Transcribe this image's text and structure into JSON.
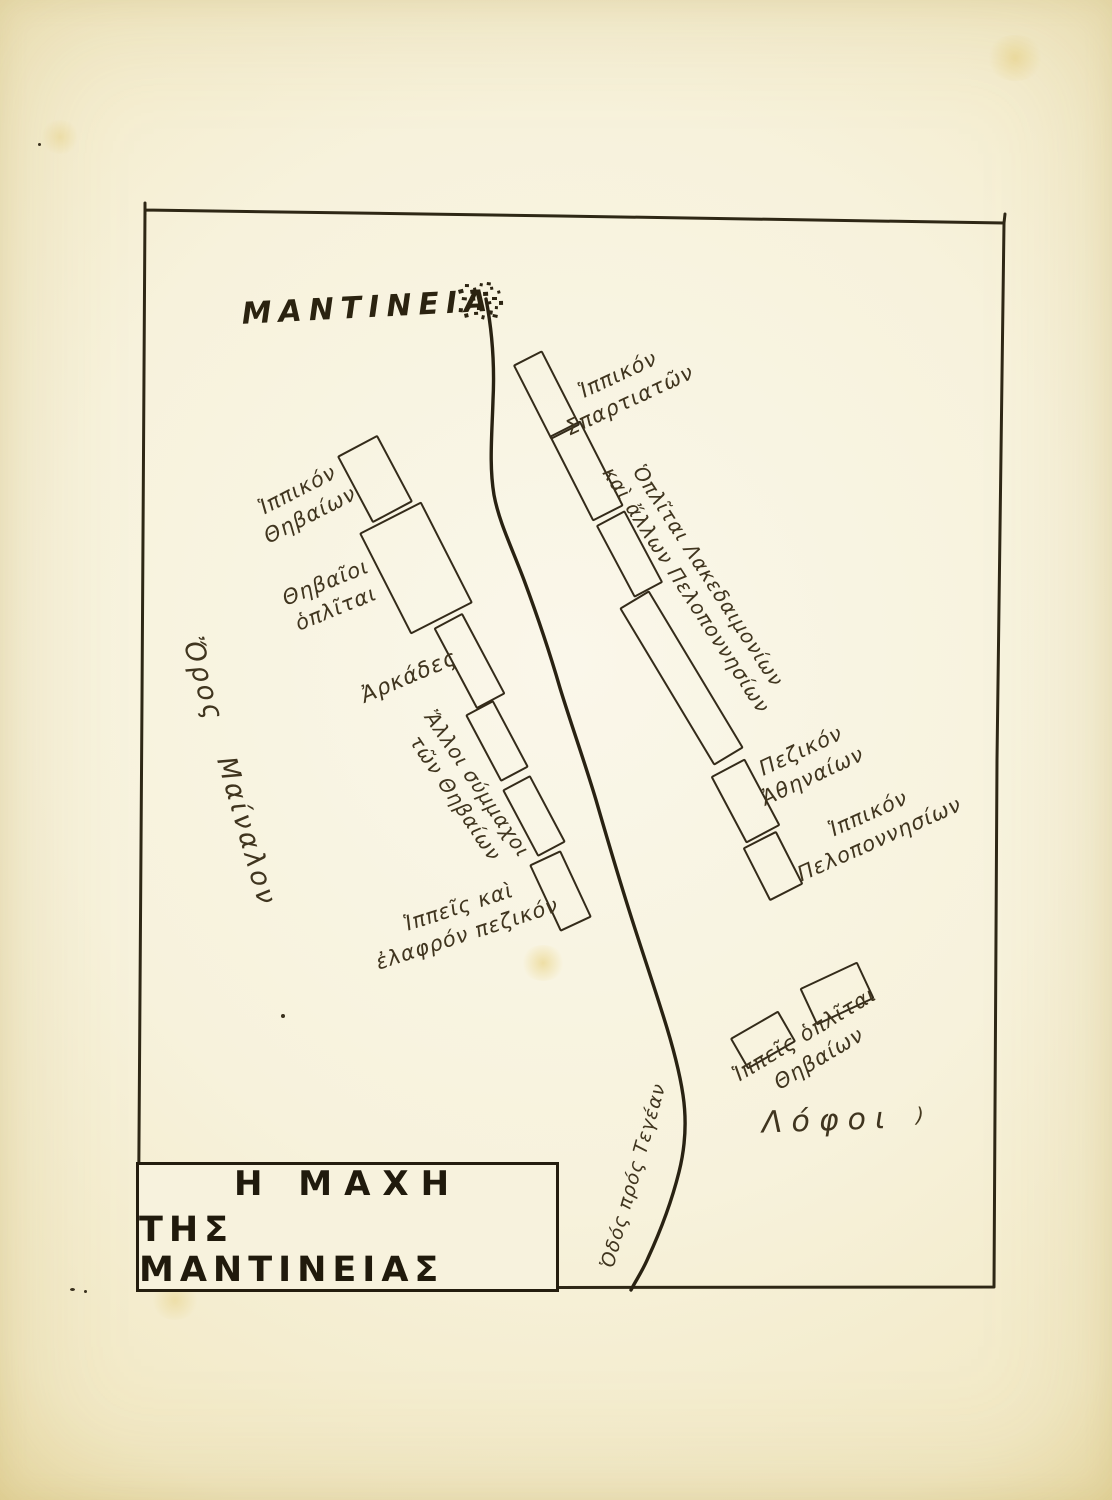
{
  "page": {
    "kind": "hand-drawn battle map, scanned book plate",
    "language": "Greek (polytonic)"
  },
  "title_box": {
    "line1": "Η ΜΑΧΗ",
    "line2": "ΤΗΣ ΜΑΝΤΙΝΕΙΑΣ"
  },
  "map": {
    "ink_color": "#342b1a",
    "paper_color": "#f7f2dc",
    "city": {
      "name": "MANTINEIA",
      "symbol": "town-cluster"
    },
    "terrain": {
      "mountain": "Ὄρος  Μαίναλον",
      "hills": "Λόφοι",
      "road": "Ὁδός πρός Τεγέαν"
    },
    "units": [
      {
        "name": "theban-cavalry-box",
        "x": 373,
        "y": 477,
        "w": 42,
        "h": 72,
        "rot": -28
      },
      {
        "name": "theban-hoplites-box",
        "x": 414,
        "y": 566,
        "w": 66,
        "h": 110,
        "rot": -27
      },
      {
        "name": "arcadians-box",
        "x": 467,
        "y": 659,
        "w": 29,
        "h": 88,
        "rot": -28
      },
      {
        "name": "theban-allies-box-1",
        "x": 495,
        "y": 739,
        "w": 28,
        "h": 72,
        "rot": -28
      },
      {
        "name": "theban-allies-box-2",
        "x": 532,
        "y": 814,
        "w": 28,
        "h": 72,
        "rot": -28
      },
      {
        "name": "light-infantry-box",
        "x": 558,
        "y": 889,
        "w": 31,
        "h": 70,
        "rot": -25
      },
      {
        "name": "spartan-cavalry-box",
        "x": 544,
        "y": 393,
        "w": 29,
        "h": 80,
        "rot": -27
      },
      {
        "name": "lacedaemonian-box-1",
        "x": 584,
        "y": 469,
        "w": 31,
        "h": 92,
        "rot": -27
      },
      {
        "name": "lacedaemonian-box-2",
        "x": 627,
        "y": 552,
        "w": 29,
        "h": 78,
        "rot": -28
      },
      {
        "name": "lacedaemonian-box-long",
        "x": 679,
        "y": 676,
        "w": 31,
        "h": 180,
        "rot": -31
      },
      {
        "name": "athenian-infantry-box",
        "x": 743,
        "y": 799,
        "w": 35,
        "h": 72,
        "rot": -28
      },
      {
        "name": "peloponnesian-cavalry-box",
        "x": 771,
        "y": 864,
        "w": 34,
        "h": 56,
        "rot": -27
      },
      {
        "name": "theban-detachment-box-1",
        "x": 761,
        "y": 1038,
        "w": 52,
        "h": 32,
        "rot": -30
      },
      {
        "name": "theban-detachment-box-2",
        "x": 835,
        "y": 991,
        "w": 60,
        "h": 37,
        "rot": -25
      }
    ],
    "labels": [
      {
        "name": "mantineia-city-label",
        "lines": [
          "MANTINEIA"
        ],
        "x": 368,
        "y": 308,
        "rot": -3,
        "size": 30,
        "ls": 7,
        "cls": "city-label"
      },
      {
        "name": "spartan-cavalry-label",
        "lines": [
          "Ἱππικόν",
          "Σπαρτιατῶν"
        ],
        "x": 624,
        "y": 388,
        "rot": -25,
        "size": 21
      },
      {
        "name": "lacedaemonian-hoplites-label",
        "lines": [
          "Ὁπλῖται Λακεδαιμονίων",
          "καὶ ἄλλων Πελοποννησίων"
        ],
        "x": 697,
        "y": 583,
        "rot": 57,
        "size": 20
      },
      {
        "name": "athenian-infantry-label",
        "lines": [
          "Πεζικόν",
          "Ἀθηναίων"
        ],
        "x": 807,
        "y": 764,
        "rot": -25,
        "size": 21
      },
      {
        "name": "peloponnesian-cavalry-label",
        "lines": [
          "Ἱππικόν",
          "Πελοποννησίων"
        ],
        "x": 874,
        "y": 827,
        "rot": -24,
        "size": 21
      },
      {
        "name": "theban-detachment-label",
        "lines": [
          "Ἱππεῖς ὁπλῖται",
          "Θηβαίων"
        ],
        "x": 812,
        "y": 1047,
        "rot": -31,
        "size": 21
      },
      {
        "name": "hills-label",
        "lines": [
          "Λόφοι"
        ],
        "x": 828,
        "y": 1121,
        "rot": -2,
        "size": 30,
        "ls": 9
      },
      {
        "name": "theban-cavalry-label",
        "lines": [
          "Ἱππικόν",
          "Θηβαίων"
        ],
        "x": 304,
        "y": 503,
        "rot": -27,
        "size": 21
      },
      {
        "name": "theban-hoplites-label",
        "lines": [
          "Θηβαῖοι",
          "ὁπλῖται"
        ],
        "x": 331,
        "y": 596,
        "rot": -22,
        "size": 21
      },
      {
        "name": "arcadians-label",
        "lines": [
          "Ἀρκάδες"
        ],
        "x": 409,
        "y": 677,
        "rot": -23,
        "size": 22
      },
      {
        "name": "theban-allies-label",
        "lines": [
          "Ἄλλοι σύμμαχοι",
          "τῶν Θηβαίων"
        ],
        "x": 466,
        "y": 791,
        "rot": 56,
        "size": 20
      },
      {
        "name": "light-infantry-label",
        "lines": [
          "Ἱππεῖς καὶ",
          "ἐλαφρόν πεζικόν"
        ],
        "x": 463,
        "y": 921,
        "rot": -18,
        "size": 21
      },
      {
        "name": "mountain-label",
        "lines": [
          "Ὄρος  Μαίναλον"
        ],
        "x": 229,
        "y": 772,
        "rot": 74,
        "size": 27,
        "ls": 3,
        "ws": 26
      },
      {
        "name": "road-label",
        "lines": [
          "Ὁδός πρός Τεγέαν"
        ],
        "x": 634,
        "y": 1176,
        "rot": -74,
        "size": 19
      }
    ]
  }
}
